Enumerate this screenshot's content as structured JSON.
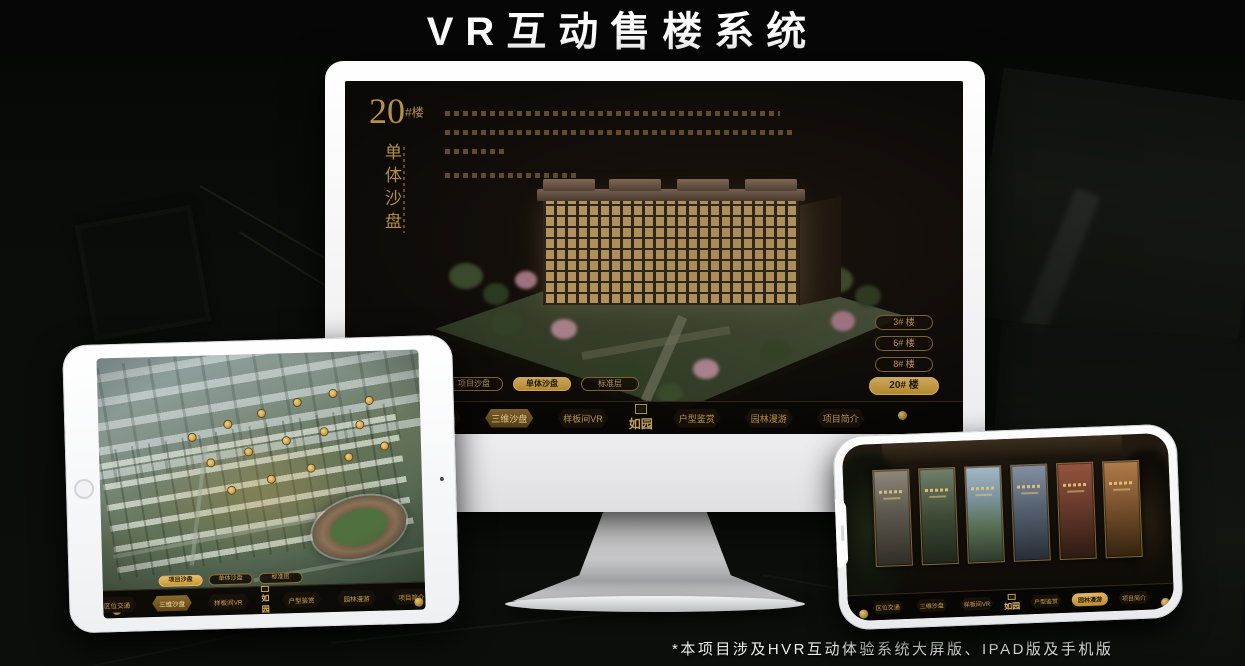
{
  "page": {
    "title": "VR互动售楼系统",
    "footnote": "*本项目涉及HVR互动体验系统大屏版、IPAD版及手机版"
  },
  "colors": {
    "gold": "#CFA454",
    "gold_bright": "#E6BD6B",
    "screen_bg": "#0C0907"
  },
  "monitor": {
    "heading": {
      "number": "20",
      "unit": "#楼",
      "subtitle_vertical": "单体沙盘"
    },
    "building_buttons": [
      {
        "label": "3# 楼",
        "active": false
      },
      {
        "label": "6# 楼",
        "active": false
      },
      {
        "label": "8# 楼",
        "active": false
      },
      {
        "label": "20# 楼",
        "active": true
      }
    ],
    "sub_tabs": [
      {
        "label": "项目沙盘",
        "active": false
      },
      {
        "label": "单体沙盘",
        "active": true
      },
      {
        "label": "标准层",
        "active": false
      }
    ],
    "nav": {
      "left": [
        "区位交通",
        "三维沙盘",
        "样板间VR"
      ],
      "right": [
        "户型鉴赏",
        "园林漫游",
        "项目简介"
      ],
      "active": "三维沙盘",
      "logo": "如园"
    }
  },
  "tablet": {
    "sub_tabs": [
      {
        "label": "项目沙盘",
        "active": true
      },
      {
        "label": "单体沙盘",
        "active": false
      },
      {
        "label": "标准层",
        "active": false
      }
    ],
    "nav": {
      "left": [
        "区位交通",
        "三维沙盘",
        "样板间VR"
      ],
      "right": [
        "户型鉴赏",
        "园林漫游",
        "项目简介"
      ],
      "active": "三维沙盘",
      "logo": "如园"
    }
  },
  "phone": {
    "nav": {
      "left": [
        "区位交通",
        "三维沙盘",
        "样板间VR"
      ],
      "right": [
        "户型鉴赏",
        "园林漫游",
        "项目简介"
      ],
      "active": "园林漫游",
      "logo": "如园"
    }
  }
}
